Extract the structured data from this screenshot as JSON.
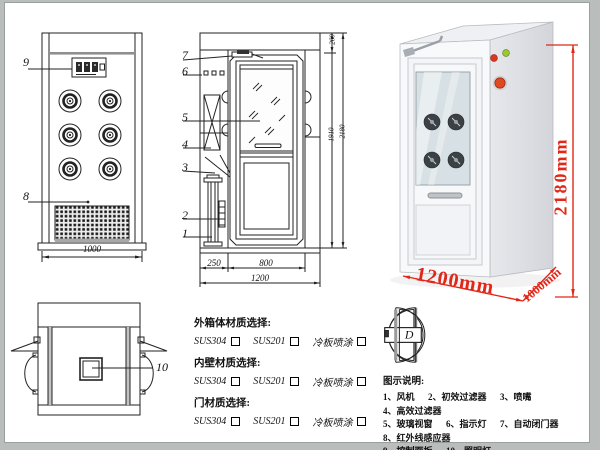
{
  "front_view": {
    "label_control_panel": "9",
    "label_grille": "8",
    "dim_width": "1000"
  },
  "side_view": {
    "labels": {
      "door_closer": "7",
      "indicators": "6",
      "glass_window": "5",
      "hepa_filter": "4",
      "nozzle": "3",
      "prefilter": "2",
      "fan": "1"
    },
    "dim_left_depth": "250",
    "dim_door_width": "800",
    "dim_total_depth": "1200",
    "dim_top_section": "260",
    "dim_door_height": "1910",
    "dim_total_height": "2180"
  },
  "photo": {
    "dim_height": "2180mm",
    "dim_width": "1200mm",
    "dim_depth": "1000mm",
    "annotation_color": "#e02718"
  },
  "top_view": {
    "label_lamp": "10"
  },
  "materials": {
    "groups": [
      {
        "title": "外箱体材质选择:",
        "options": [
          "SUS304",
          "SUS201",
          "冷板喷涂"
        ]
      },
      {
        "title": "内壁材质选择:",
        "options": [
          "SUS304",
          "SUS201",
          "冷板喷涂"
        ]
      },
      {
        "title": "门材质选择:",
        "options": [
          "SUS304",
          "SUS201",
          "冷板喷涂"
        ]
      }
    ]
  },
  "door_options": {
    "labels": [
      "A",
      "B",
      "C",
      "D"
    ]
  },
  "legend": {
    "title": "图示说明:",
    "items": [
      "1、风机",
      "2、初效过滤器",
      "3、喷嘴",
      "4、高效过滤器",
      "5、玻璃视窗",
      "6、指示灯",
      "7、自动闭门器",
      "8、红外线感应器",
      "9、控制面板",
      "10、照明灯"
    ]
  }
}
